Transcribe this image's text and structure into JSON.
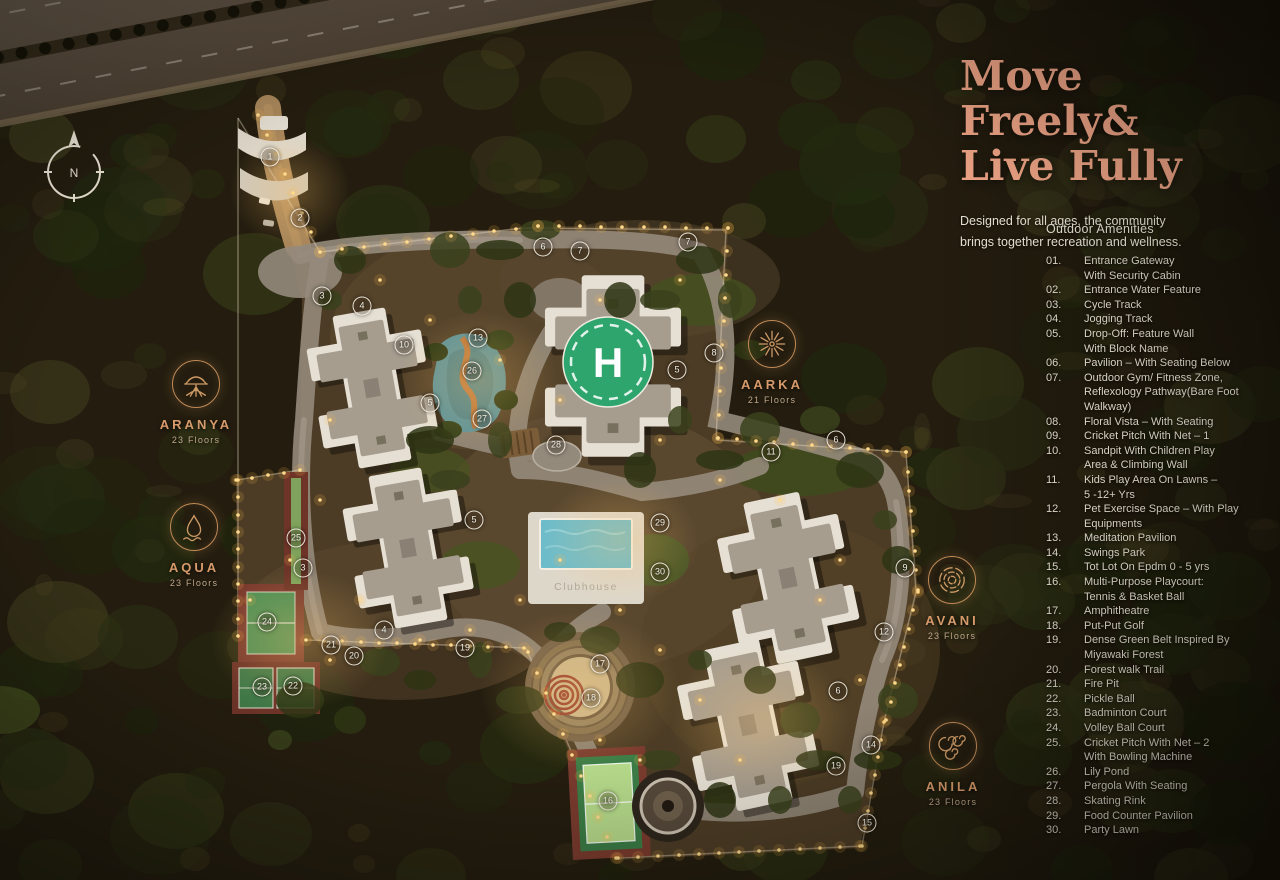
{
  "header": {
    "title_line1": "Move Freely&",
    "title_line2": "Live Fully",
    "subtitle": "Designed for all ages, the community\nbrings together recreation and wellness."
  },
  "amenities": {
    "heading": "Outdoor Amenities",
    "items": [
      {
        "num": "01.",
        "text": "Entrance Gateway\nWith Security Cabin"
      },
      {
        "num": "02.",
        "text": "Entrance Water Feature"
      },
      {
        "num": "03.",
        "text": "Cycle Track"
      },
      {
        "num": "04.",
        "text": "Jogging Track"
      },
      {
        "num": "05.",
        "text": "Drop-Off: Feature Wall\nWith Block Name"
      },
      {
        "num": "06.",
        "text": "Pavilion – With Seating Below"
      },
      {
        "num": "07.",
        "text": "Outdoor Gym/ Fitness Zone,\nReflexology Pathway(Bare Foot\nWalkway)"
      },
      {
        "num": "08.",
        "text": "Floral Vista – With Seating"
      },
      {
        "num": "09.",
        "text": "Cricket Pitch With Net – 1"
      },
      {
        "num": "10.",
        "text": "Sandpit With Children Play\nArea & Climbing Wall"
      },
      {
        "num": "11.",
        "text": "Kids Play Area On Lawns –\n5 -12+ Yrs"
      },
      {
        "num": "12.",
        "text": "Pet Exercise Space – With Play\nEquipments"
      },
      {
        "num": "13.",
        "text": "Meditation Pavilion"
      },
      {
        "num": "14.",
        "text": "Swings Park"
      },
      {
        "num": "15.",
        "text": "Tot Lot On Epdm 0 - 5 yrs"
      },
      {
        "num": "16.",
        "text": "Multi-Purpose Playcourt:\nTennis & Basket Ball"
      },
      {
        "num": "17.",
        "text": "Amphitheatre"
      },
      {
        "num": "18.",
        "text": "Put-Put Golf"
      },
      {
        "num": "19.",
        "text": "Dense Green Belt Inspired By\nMiyawaki Forest"
      },
      {
        "num": "20.",
        "text": "Forest walk Trail"
      },
      {
        "num": "21.",
        "text": "Fire Pit"
      },
      {
        "num": "22.",
        "text": "Pickle Ball"
      },
      {
        "num": "23.",
        "text": "Badminton Court"
      },
      {
        "num": "24.",
        "text": "Volley Ball Court"
      },
      {
        "num": "25.",
        "text": "Cricket Pitch With Net – 2\nWith Bowling Machine"
      },
      {
        "num": "26.",
        "text": "Lily Pond"
      },
      {
        "num": "27.",
        "text": "Pergola With Seating"
      },
      {
        "num": "28.",
        "text": "Skating Rink"
      },
      {
        "num": "29.",
        "text": "Food Counter Pavilion"
      },
      {
        "num": "30.",
        "text": "Party Lawn"
      }
    ]
  },
  "towers": [
    {
      "name": "ARANYA",
      "floors": "23 Floors",
      "icon": "tree-icon",
      "x": 196,
      "y": 360
    },
    {
      "name": "AQUA",
      "floors": "23 Floors",
      "icon": "droplet-icon",
      "x": 194,
      "y": 503
    },
    {
      "name": "AARKA",
      "floors": "21 Floors",
      "icon": "sun-icon",
      "x": 772,
      "y": 320
    },
    {
      "name": "AVANI",
      "floors": "23 Floors",
      "icon": "rings-icon",
      "x": 952,
      "y": 556
    },
    {
      "name": "ANILA",
      "floors": "23 Floors",
      "icon": "spiral-icon",
      "x": 953,
      "y": 722
    }
  ],
  "map": {
    "compass_label": "N",
    "helipad_label": "H",
    "clubhouse_label": "Clubhouse"
  },
  "markers": [
    {
      "n": "1",
      "x": 270,
      "y": 157
    },
    {
      "n": "2",
      "x": 300,
      "y": 218
    },
    {
      "n": "3",
      "x": 322,
      "y": 296
    },
    {
      "n": "4",
      "x": 362,
      "y": 306
    },
    {
      "n": "10",
      "x": 404,
      "y": 345
    },
    {
      "n": "13",
      "x": 478,
      "y": 338
    },
    {
      "n": "26",
      "x": 472,
      "y": 371
    },
    {
      "n": "27",
      "x": 482,
      "y": 419
    },
    {
      "n": "5",
      "x": 430,
      "y": 403
    },
    {
      "n": "6",
      "x": 543,
      "y": 247
    },
    {
      "n": "7",
      "x": 580,
      "y": 251
    },
    {
      "n": "7",
      "x": 688,
      "y": 242
    },
    {
      "n": "8",
      "x": 714,
      "y": 353
    },
    {
      "n": "5",
      "x": 677,
      "y": 370
    },
    {
      "n": "28",
      "x": 556,
      "y": 445
    },
    {
      "n": "11",
      "x": 771,
      "y": 452
    },
    {
      "n": "6",
      "x": 836,
      "y": 440
    },
    {
      "n": "29",
      "x": 660,
      "y": 523
    },
    {
      "n": "30",
      "x": 660,
      "y": 572
    },
    {
      "n": "25",
      "x": 296,
      "y": 538
    },
    {
      "n": "5",
      "x": 474,
      "y": 520
    },
    {
      "n": "3",
      "x": 303,
      "y": 568
    },
    {
      "n": "24",
      "x": 267,
      "y": 622
    },
    {
      "n": "21",
      "x": 331,
      "y": 645
    },
    {
      "n": "23",
      "x": 262,
      "y": 687
    },
    {
      "n": "22",
      "x": 293,
      "y": 686
    },
    {
      "n": "4",
      "x": 384,
      "y": 630
    },
    {
      "n": "20",
      "x": 354,
      "y": 656
    },
    {
      "n": "19",
      "x": 465,
      "y": 648
    },
    {
      "n": "17",
      "x": 600,
      "y": 664
    },
    {
      "n": "18",
      "x": 591,
      "y": 698
    },
    {
      "n": "16",
      "x": 608,
      "y": 801
    },
    {
      "n": "9",
      "x": 905,
      "y": 568
    },
    {
      "n": "12",
      "x": 884,
      "y": 632
    },
    {
      "n": "6",
      "x": 838,
      "y": 691
    },
    {
      "n": "14",
      "x": 871,
      "y": 745
    },
    {
      "n": "19",
      "x": 836,
      "y": 766
    },
    {
      "n": "15",
      "x": 867,
      "y": 823
    }
  ],
  "colors": {
    "accent": "#ECA284",
    "gold": "#C08A56",
    "helipad_green": "#2FA56E",
    "pool_blue": "#6CBCCB",
    "court_green": "#4F8F55",
    "court_red": "#7A3B2E"
  }
}
